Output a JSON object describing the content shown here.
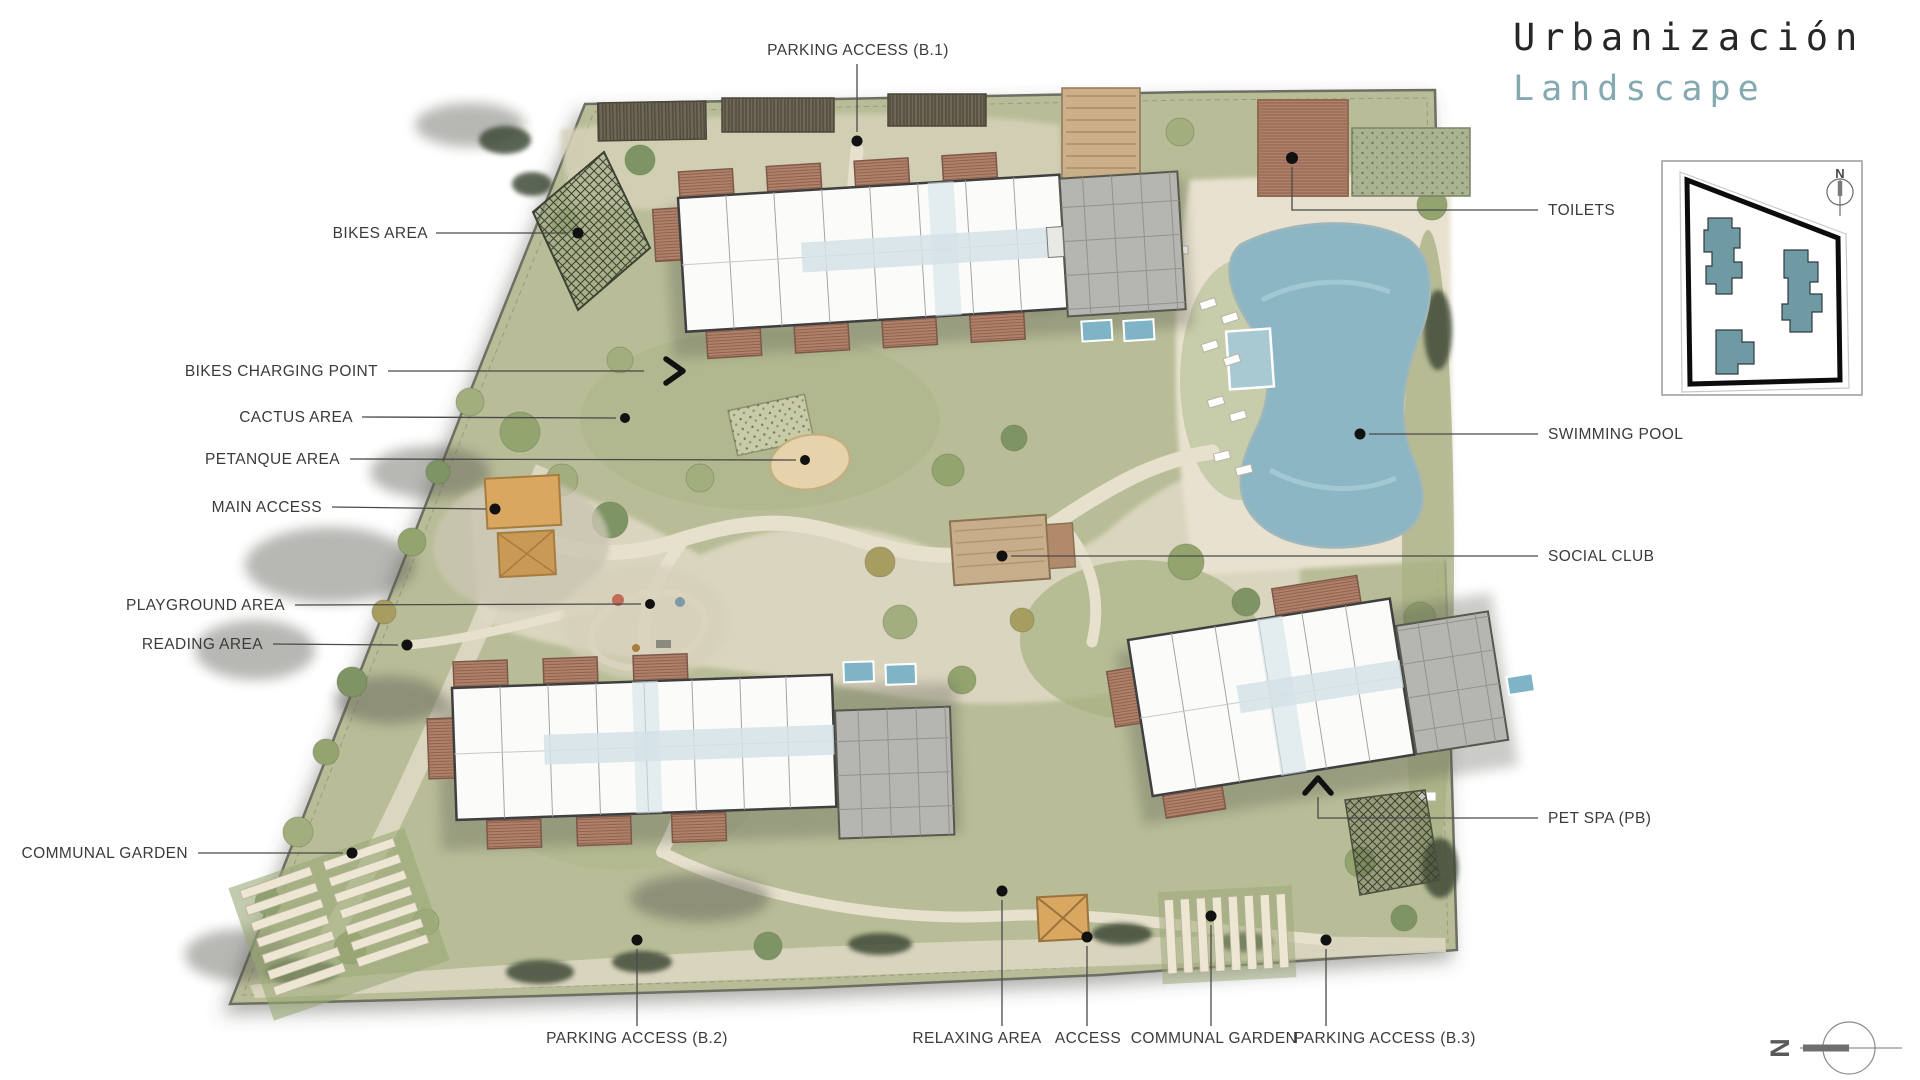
{
  "title": {
    "line1": "Urbanización",
    "line2": "Landscape",
    "line1_color": "#262626",
    "line2_color": "#84a9b1"
  },
  "callouts": {
    "parking_b1": "PARKING ACCESS (B.1)",
    "bikes_area": "BIKES AREA",
    "bikes_charging": "BIKES CHARGING POINT",
    "cactus": "CACTUS AREA",
    "petanque": "PETANQUE AREA",
    "main_access": "MAIN ACCESS",
    "playground": "PLAYGROUND AREA",
    "reading": "READING AREA",
    "communal_left": "COMMUNAL GARDEN",
    "toilets": "TOILETS",
    "pool": "SWIMMING POOL",
    "social_club": "SOCIAL CLUB",
    "pet_spa": "PET SPA (PB)",
    "parking_b2": "PARKING ACCESS (B.2)",
    "relaxing": "RELAXING AREA",
    "access": "ACCESS",
    "communal_bottom": "COMMUNAL GARDEN",
    "parking_b3": "PARKING ACCESS (B.3)"
  },
  "keyplan": {
    "north_label": "N"
  },
  "plan_compass": {
    "north_label": "N"
  },
  "colors": {
    "site_green": "#b8bd97",
    "water_blue": "#8cb6c4",
    "keyplan_building": "#6f9aa4",
    "label_text": "#3b3b3b",
    "deck_brown": "#ae7f67"
  }
}
